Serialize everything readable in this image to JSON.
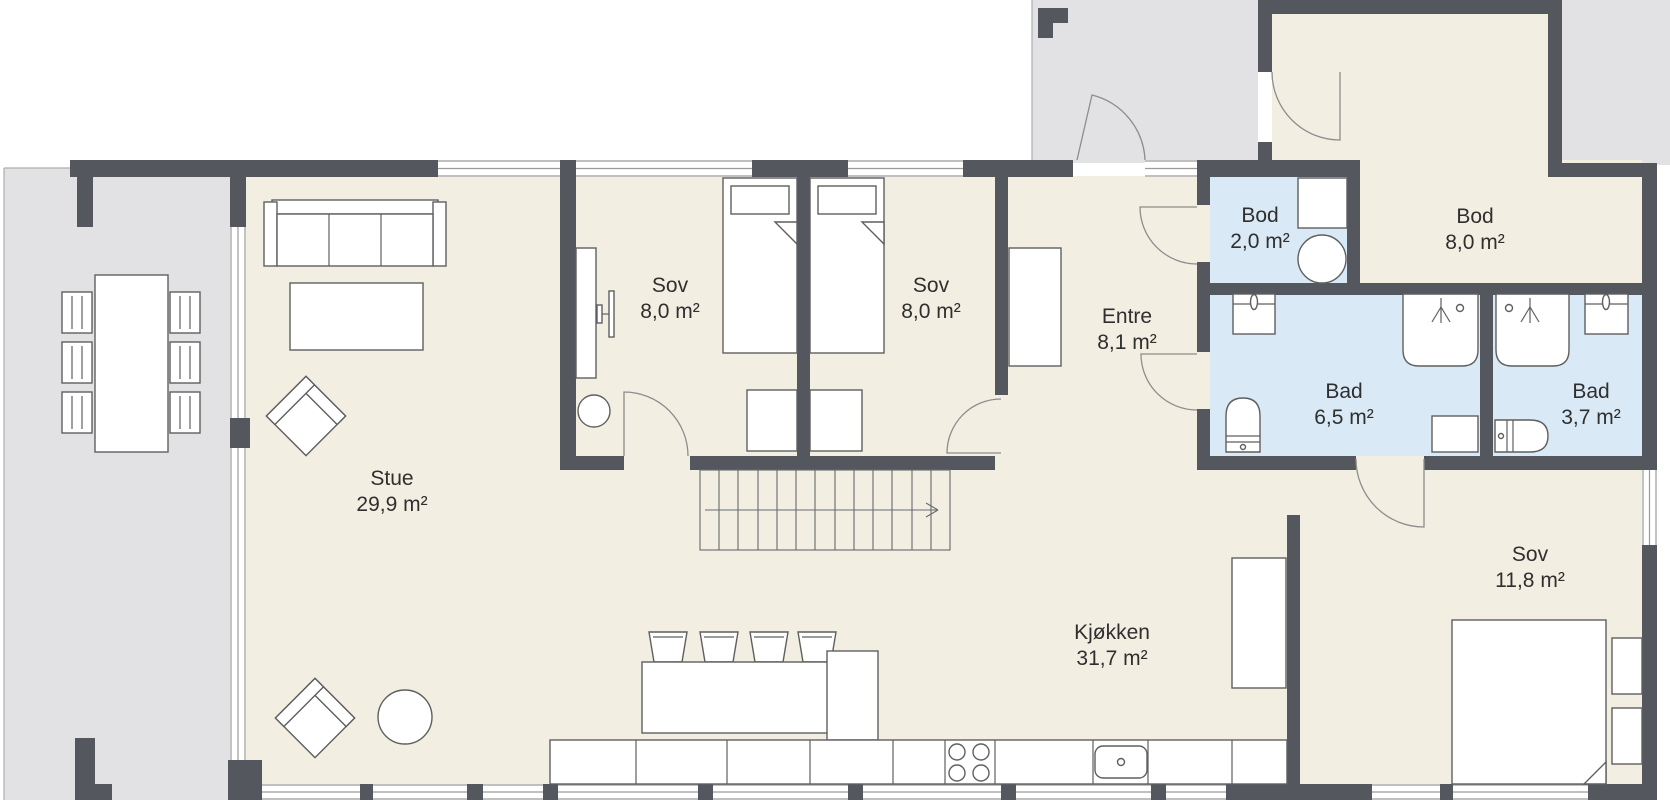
{
  "title": "Floor plan",
  "rooms": {
    "stue": {
      "name": "Stue",
      "area": "29,9 m²"
    },
    "sov1": {
      "name": "Sov",
      "area": "8,0 m²"
    },
    "sov2": {
      "name": "Sov",
      "area": "8,0 m²"
    },
    "entre": {
      "name": "Entre",
      "area": "8,1 m²"
    },
    "bod_small": {
      "name": "Bod",
      "area": "2,0 m²"
    },
    "bod_large": {
      "name": "Bod",
      "area": "8,0 m²"
    },
    "bad_large": {
      "name": "Bad",
      "area": "6,5 m²"
    },
    "bad_small": {
      "name": "Bad",
      "area": "3,7 m²"
    },
    "kjokken": {
      "name": "Kjøkken",
      "area": "31,7 m²"
    },
    "sov3": {
      "name": "Sov",
      "area": "11,8 m²"
    }
  },
  "colors": {
    "wall": "#54575d",
    "floor": "#f3eee2",
    "wet_room_floor": "#d9e9f5",
    "outdoor": "#e2e2e4",
    "furniture_outline": "#5f5f5f",
    "label_text": "#2f2f2f"
  }
}
